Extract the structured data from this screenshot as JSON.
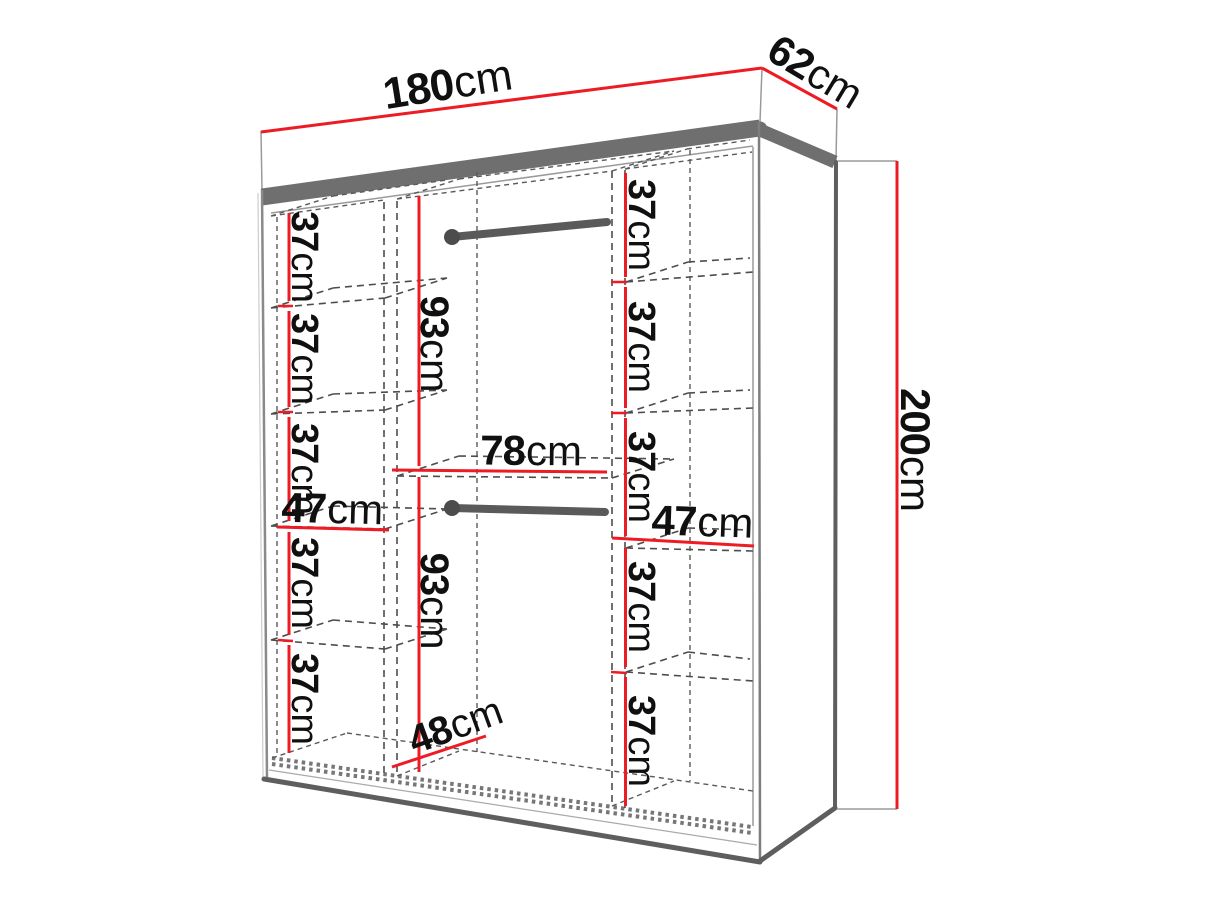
{
  "diagram": {
    "kind": "wardrobe-dimension-drawing",
    "unit": "cm",
    "colors": {
      "dimension_line": "#ed1c24",
      "label_text": "#101010",
      "frame_dark": "#6f6f6f",
      "outline": "#9a9a9a",
      "dashed_line": "#4d4d4d",
      "background": "#ffffff"
    },
    "overall": {
      "width": {
        "num": "180",
        "unit": "cm"
      },
      "depth": {
        "num": "62",
        "unit": "cm"
      },
      "height": {
        "num": "200",
        "unit": "cm"
      }
    },
    "left_column": {
      "width": {
        "num": "47",
        "unit": "cm"
      },
      "shelf_gaps": [
        {
          "num": "37",
          "unit": "cm"
        },
        {
          "num": "37",
          "unit": "cm"
        },
        {
          "num": "37",
          "unit": "cm"
        },
        {
          "num": "37",
          "unit": "cm"
        },
        {
          "num": "37",
          "unit": "cm"
        }
      ]
    },
    "middle_column": {
      "width": {
        "num": "78",
        "unit": "cm"
      },
      "depth": {
        "num": "48",
        "unit": "cm"
      },
      "hanging_top": {
        "num": "93",
        "unit": "cm"
      },
      "hanging_bottom": {
        "num": "93",
        "unit": "cm"
      }
    },
    "right_column": {
      "width": {
        "num": "47",
        "unit": "cm"
      },
      "shelf_gaps": [
        {
          "num": "37",
          "unit": "cm"
        },
        {
          "num": "37",
          "unit": "cm"
        },
        {
          "num": "37",
          "unit": "cm"
        },
        {
          "num": "37",
          "unit": "cm"
        },
        {
          "num": "37",
          "unit": "cm"
        }
      ]
    }
  }
}
